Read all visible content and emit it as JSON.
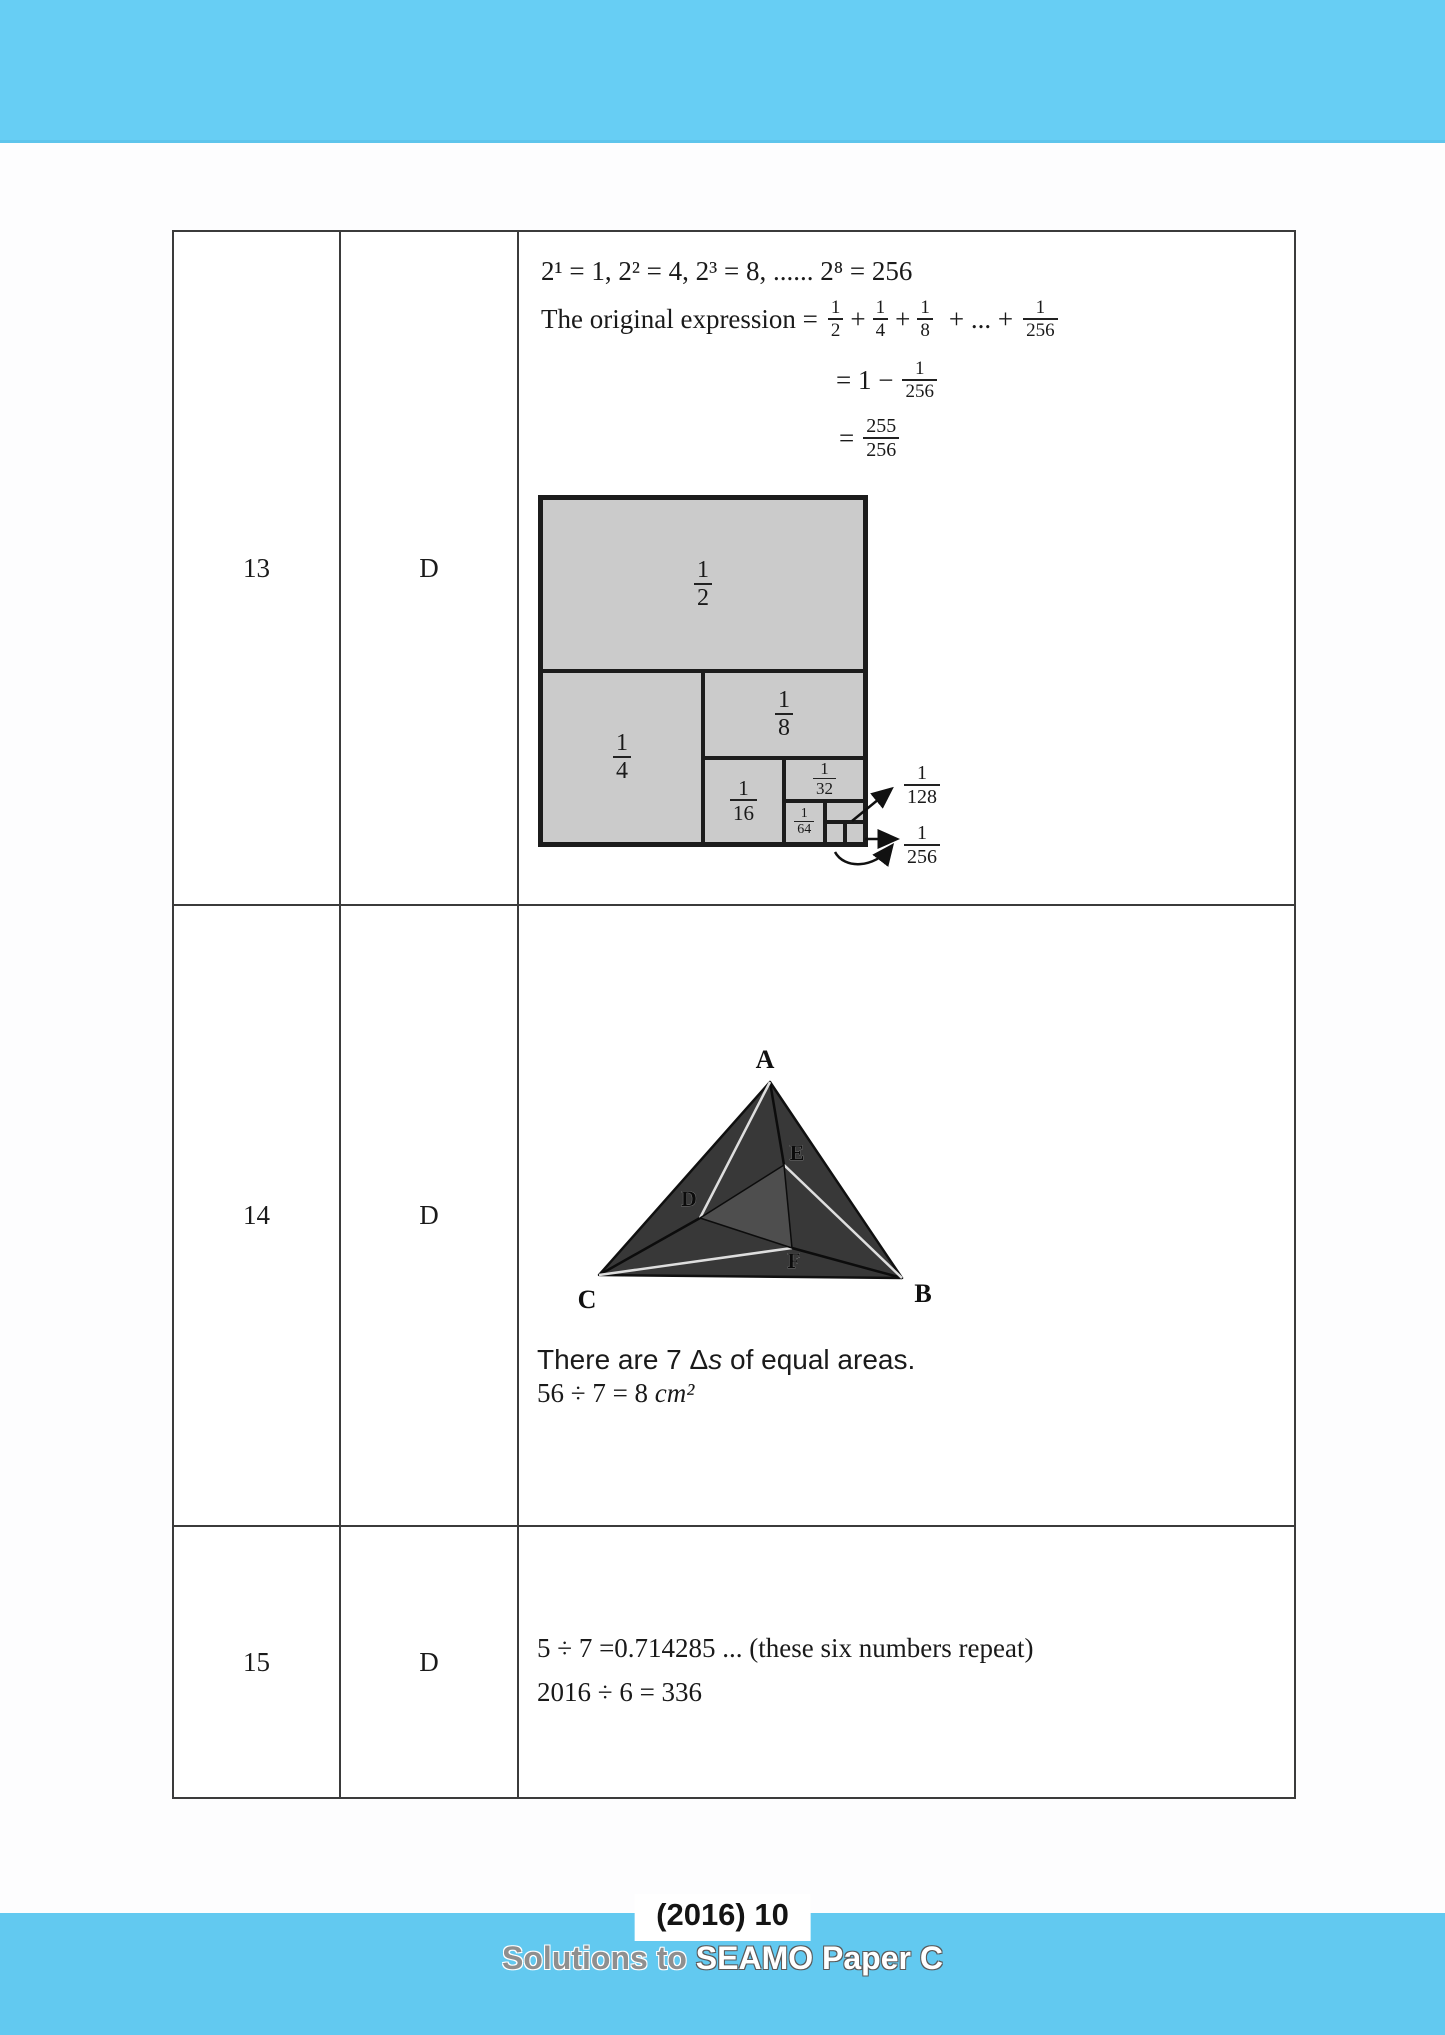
{
  "colors": {
    "accent_blue_top": "#67cef4",
    "accent_blue_bottom": "#62c9f0",
    "diagram_gray": "#cbcbcb",
    "triangle_dark": "#383838",
    "triangle_inner": "#4e4e4e"
  },
  "q13": {
    "number": "13",
    "answer": "D",
    "line_powers": "2¹ = 1, 2² = 4, 2³ = 8, ...... 2⁸ = 256",
    "expr_prefix": "The original expression =",
    "plus": "+",
    "dots": "+ ... +",
    "f2": {
      "n": "1",
      "d": "2"
    },
    "f4": {
      "n": "1",
      "d": "4"
    },
    "f8": {
      "n": "1",
      "d": "8"
    },
    "f256": {
      "n": "1",
      "d": "256"
    },
    "eq1_eq": "= 1 −",
    "eq1_frac": {
      "n": "1",
      "d": "256"
    },
    "eq2_eq": "=",
    "eq2_frac": {
      "n": "255",
      "d": "256"
    },
    "diagram": {
      "half": {
        "n": "1",
        "d": "2"
      },
      "quarter": {
        "n": "1",
        "d": "4"
      },
      "eighth": {
        "n": "1",
        "d": "8"
      },
      "sixteenth": {
        "n": "1",
        "d": "16"
      },
      "thirtysecond": {
        "n": "1",
        "d": "32"
      },
      "sixtyfourth": {
        "n": "1",
        "d": "64"
      },
      "r128": {
        "n": "1",
        "d": "128"
      },
      "r256": {
        "n": "1",
        "d": "256"
      }
    }
  },
  "q14": {
    "number": "14",
    "answer": "D",
    "vertices": {
      "a": "A",
      "b": "B",
      "c": "C",
      "d": "D",
      "e": "E",
      "f": "F"
    },
    "text1_pre": "There are 7 Δ",
    "text1_var": "s",
    "text1_post": " of equal areas.",
    "calc_plain": "56 ÷ 7 = 8 ",
    "calc_unit": "cm²"
  },
  "q15": {
    "number": "15",
    "answer": "D",
    "line1": "5 ÷ 7 =0.714285 ... (these six numbers repeat)",
    "line2": "2016 ÷ 6 = 336"
  },
  "footer": {
    "page_label": "(2016) 10",
    "subtitle_gray": "Solutions to ",
    "subtitle_white": "SEAMO Paper C"
  }
}
